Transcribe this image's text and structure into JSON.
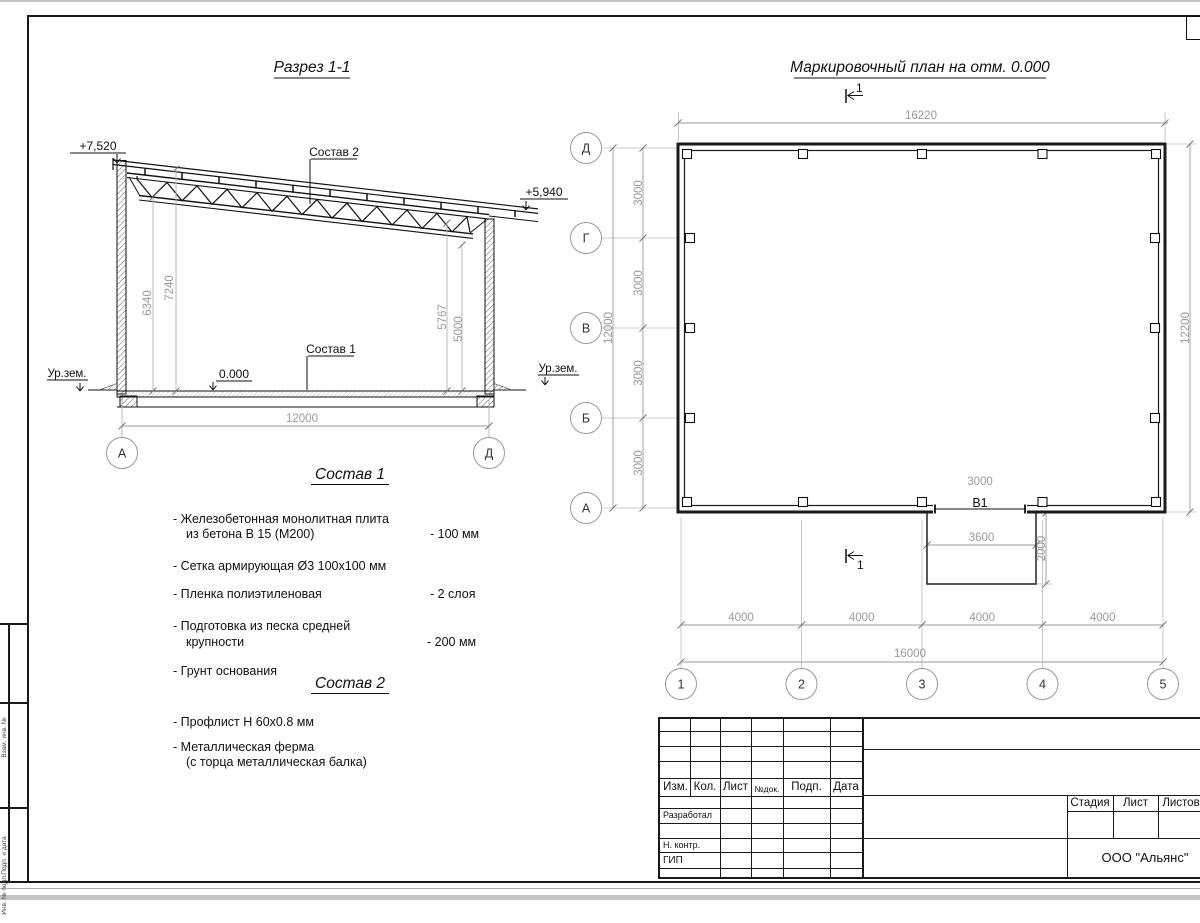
{
  "section": {
    "title": "Разрез 1-1",
    "elev_left": "+7,520",
    "elev_right": "+5,940",
    "zero": "0.000",
    "ground": "Ур.зем.",
    "span": "12000",
    "h_left_1": "6340",
    "h_left_2": "7240",
    "h_right_1": "5767",
    "h_right_2": "5000",
    "comp1_label": "Состав 1",
    "comp2_label": "Состав 2",
    "axis_left": "А",
    "axis_right": "Д"
  },
  "plan": {
    "title": "Маркировочный план на отм. 0.000",
    "dim_top": "16220",
    "dim_right": "12200",
    "dim_left_total": "12000",
    "dim_3000": "3000",
    "dim_4000": "4000",
    "dim_bottom_total": "16000",
    "opening_dim": "3000",
    "opening_label": "В1",
    "ramp_width": "3600",
    "ramp_depth": "2000",
    "section_mark": "1",
    "rows": [
      "Д",
      "Г",
      "В",
      "Б",
      "А"
    ],
    "cols": [
      "1",
      "2",
      "3",
      "4",
      "5"
    ]
  },
  "comp1": {
    "title": "Состав 1",
    "items": [
      {
        "l1": "- Железобетонная  монолитная плита",
        "l2": "из бетона В 15 (М200)",
        "v": "- 100 мм"
      },
      {
        "l1": "- Сетка армирующая Ø3 100х100 мм",
        "l2": "",
        "v": ""
      },
      {
        "l1": "- Пленка полиэтиленовая",
        "l2": "",
        "v": "-  2 слоя"
      },
      {
        "l1": "- Подготовка из песка средней",
        "l2": "крупности",
        "v": "- 200 мм"
      },
      {
        "l1": "- Грунт основания",
        "l2": "",
        "v": ""
      }
    ]
  },
  "comp2": {
    "title": "Состав 2",
    "items": [
      {
        "l1": "- Профлист Н 60х0.8 мм",
        "l2": ""
      },
      {
        "l1": "- Металлическая ферма",
        "l2": "(с торца металлическая балка)"
      }
    ]
  },
  "title_block": {
    "header": [
      "Изм.",
      "Кол.",
      "Лист",
      "№док.",
      "Подп.",
      "Дата"
    ],
    "roles": [
      "Разработал",
      "Н. контр.",
      "ГИП"
    ],
    "stage_header": [
      "Стадия",
      "Лист",
      "Листов"
    ],
    "company": "ООО \"Альянс\""
  },
  "side_strip": {
    "labels": [
      "Взам. инв. №",
      "Подп. и дата",
      "Инв. № подл."
    ]
  }
}
